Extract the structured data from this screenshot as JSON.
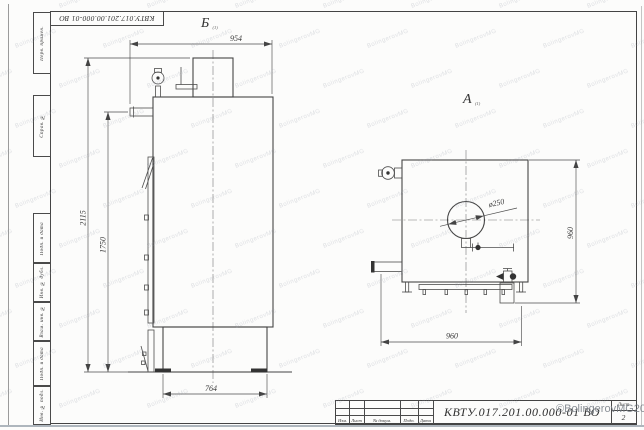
{
  "frame": {
    "stamp_top": "КВТУ.017.201.00.000-01 ВО",
    "margin_labels": [
      "Перв. примен.",
      "Справ. №",
      "Подп. и дата",
      "Инв. № дубл.",
      "Взам. инв. №",
      "Подп. и дата",
      "Инв. № подл."
    ]
  },
  "views": {
    "side_view": {
      "label": "Б",
      "label_sub": "(1)",
      "dim_top_width": "954",
      "dim_total_height": "2115",
      "dim_mid_height": "1750",
      "dim_base_width": "764"
    },
    "front_view": {
      "label": "А",
      "label_sub": "(1)",
      "dim_width": "960",
      "dim_height": "960",
      "dim_opening_diameter": "ø250"
    }
  },
  "title_block": {
    "doc_code": "КВТУ.017.201.00.000-01 ВО",
    "row_labels": [
      "Изм.",
      "Лист",
      "№ докум.",
      "Подп.",
      "Дата"
    ],
    "sheet_label": "Лист",
    "sheet_number": "2"
  },
  "watermark": {
    "tile_text": "BolingerovMG",
    "copyright": "©BolingerovMG2021"
  }
}
